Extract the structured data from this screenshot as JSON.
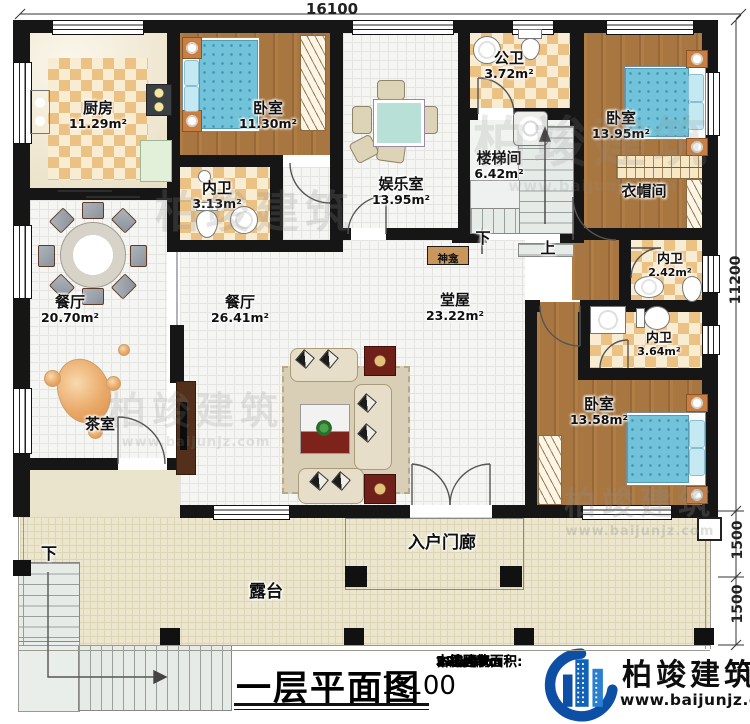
{
  "plan": {
    "dimensions": {
      "top_width": "16100",
      "right_height": "11200",
      "right_lower_1": "1500",
      "right_lower_2": "1500"
    },
    "rooms": [
      {
        "name": "厨房",
        "area": "11.29m²"
      },
      {
        "name": "卧室",
        "area": "11.30m²"
      },
      {
        "name": "内卫",
        "area": "3.13m²"
      },
      {
        "name": "娱乐室",
        "area": "13.95m²"
      },
      {
        "name": "公卫",
        "area": "3.72m²"
      },
      {
        "name": "楼梯间",
        "area": "6.42m²"
      },
      {
        "name": "卧室",
        "area": "13.95m²"
      },
      {
        "name": "衣帽间",
        "area": ""
      },
      {
        "name": "内卫",
        "area": "2.42m²"
      },
      {
        "name": "内卫",
        "area": "3.64m²"
      },
      {
        "name": "卧室",
        "area": "13.58m²"
      },
      {
        "name": "餐厅",
        "area": "20.70m²"
      },
      {
        "name": "茶室",
        "area": ""
      },
      {
        "name": "餐厅",
        "area": "26.41m²"
      },
      {
        "name": "堂屋",
        "area": "23.22m²"
      },
      {
        "name": "神龛",
        "area": ""
      },
      {
        "name": "入户门廊",
        "area": ""
      },
      {
        "name": "露台",
        "area": ""
      }
    ],
    "stairs": {
      "down_indoor": "下",
      "up_indoor": "上",
      "down_outdoor": "下"
    }
  },
  "title_block": {
    "title": "一层平面图",
    "scale": "1:100",
    "stats": [
      {
        "label": "本层建筑面积:",
        "value": "186.25m"
      },
      {
        "label": "本栋建筑面积:",
        "value": "525."
      },
      {
        "label": "占地面积:",
        "value": "235.90m"
      },
      {
        "label": "层高:",
        "value": "3.6m"
      }
    ],
    "brand": {
      "name": "柏竣建筑",
      "url": "www.baijunjz.com"
    }
  },
  "watermark": {
    "name": "柏竣建筑",
    "url": "www.baijunjz.com"
  }
}
